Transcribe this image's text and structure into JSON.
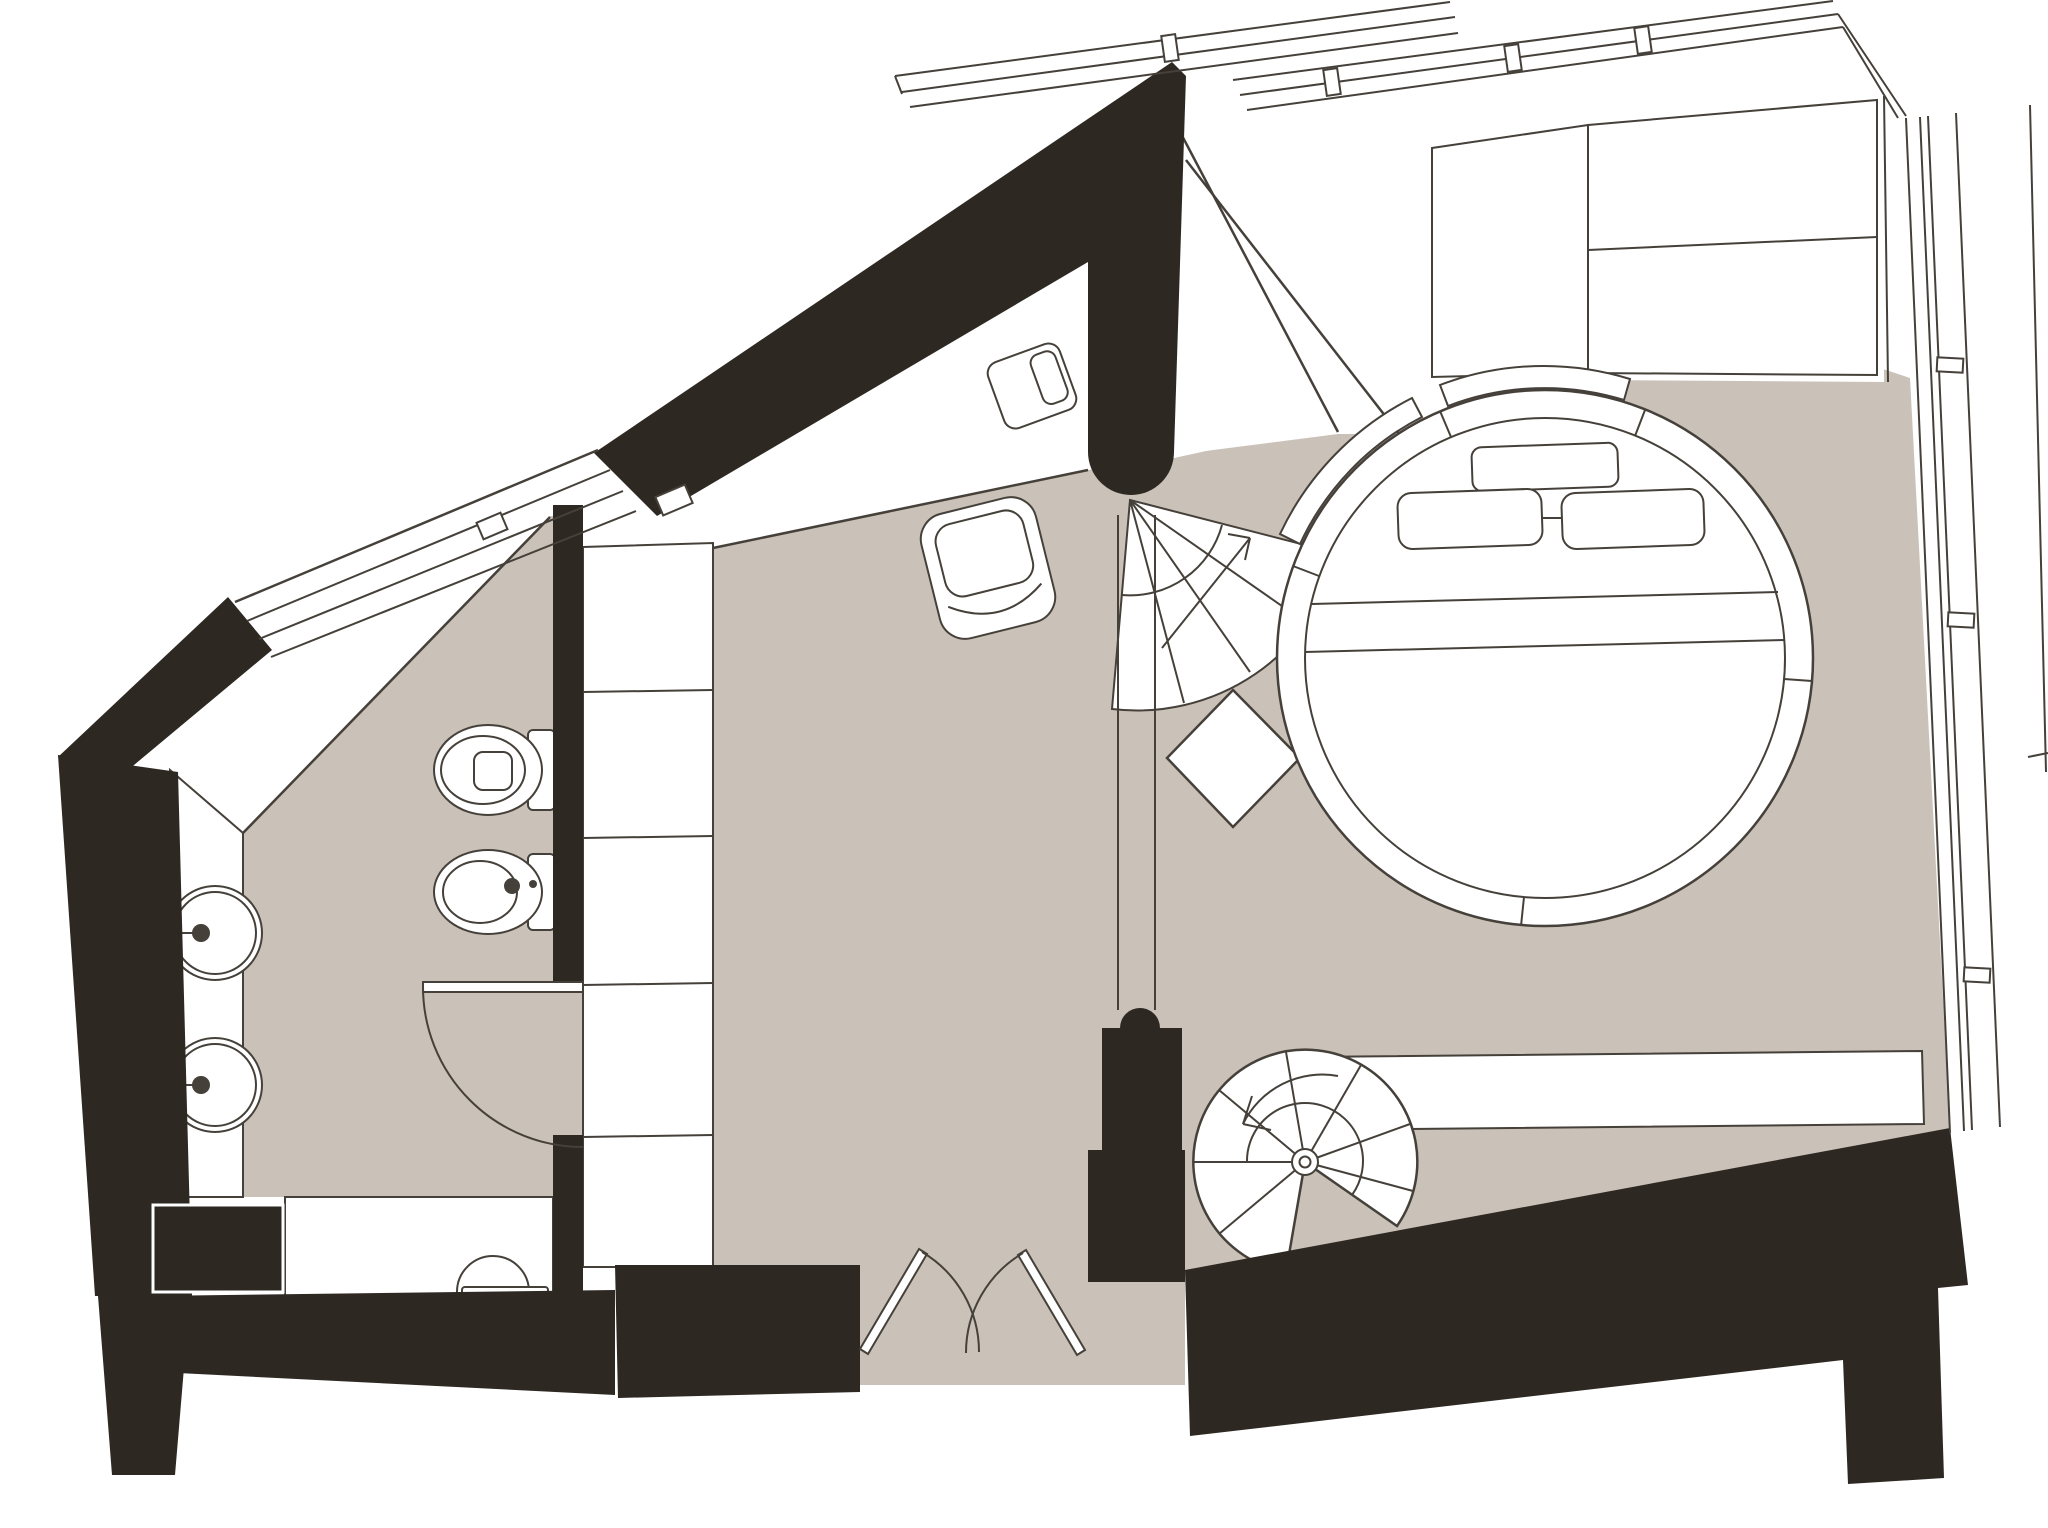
{
  "title": "apartment-floor-plan",
  "plan": {
    "type": "architectural floor plan drawing",
    "level": "single level with stairs down (spiral) and stairs up (fan)",
    "visible_text": []
  },
  "colors": {
    "background": "#ffffff",
    "wall": "#2e2823",
    "floor": "#cac2b8",
    "line": "#45403a",
    "fixture": "#ffffff"
  },
  "rooms": [
    {
      "name": "bedroom",
      "floor": "#cac2b8"
    },
    {
      "name": "hallway",
      "floor": "#cac2b8"
    },
    {
      "name": "bathroom",
      "floor": "#cac2b8"
    },
    {
      "name": "shower-room",
      "floor": "#ffffff"
    }
  ],
  "fixtures": [
    "round-bed",
    "headboard-arc",
    "headboard-cushion",
    "pillow-left",
    "pillow-right",
    "wardrobe",
    "sideboard",
    "armchair",
    "bedside-table",
    "fan-staircase-up",
    "stair-landing-diamond",
    "stair-railing",
    "spiral-staircase-down",
    "toilet",
    "bidet",
    "washbasin-upper",
    "washbasin-lower",
    "vanity-counter",
    "shower-fixture",
    "shelf-column",
    "bathroom-door-swing",
    "entry-double-door",
    "window-band-top",
    "window-band-right",
    "window-band-left-sloped"
  ]
}
